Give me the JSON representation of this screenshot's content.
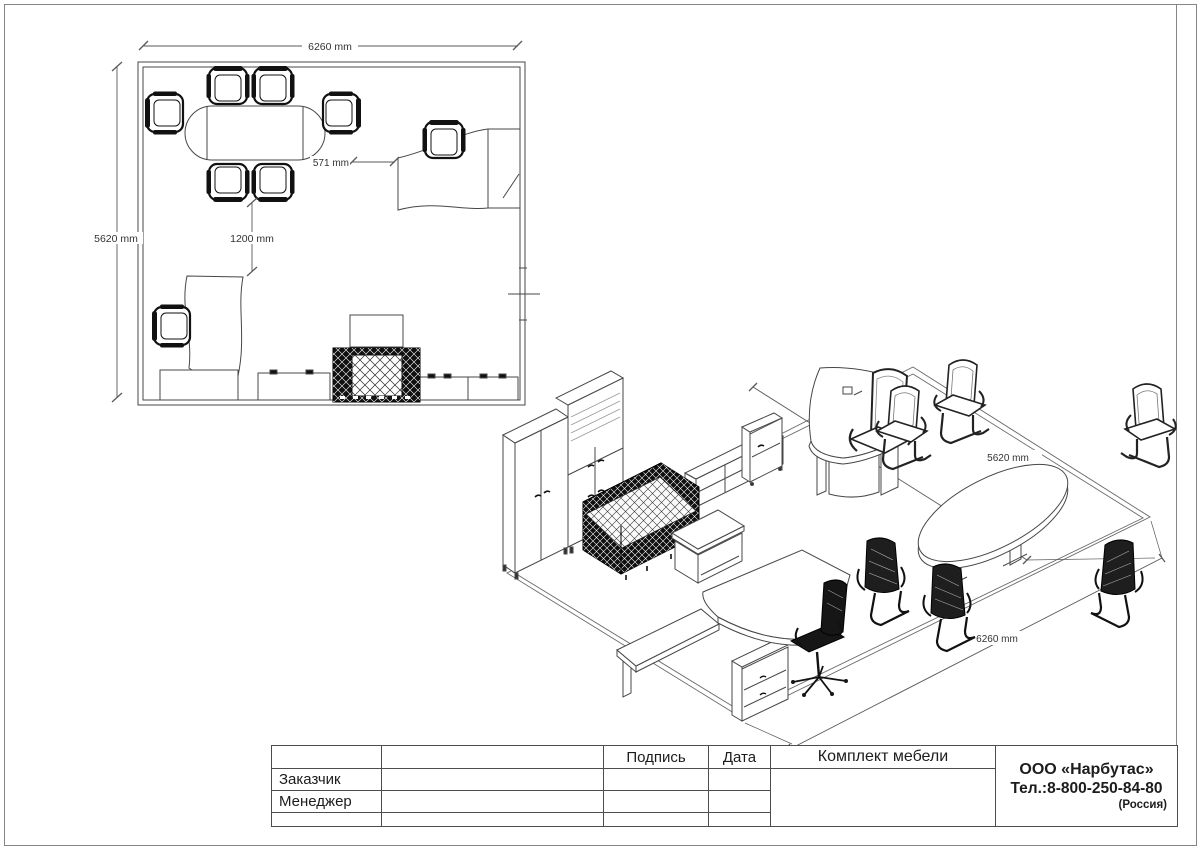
{
  "sheet": {
    "plan_view": {
      "dim_width_top": "6260 mm",
      "dim_depth_left": "5620 mm",
      "dim_table_to_desk": "571 mm",
      "dim_passage": "1200 mm"
    },
    "iso_view": {
      "dim_depth": "5620 mm",
      "dim_width": "6260 mm"
    },
    "title_block": {
      "signature_header": "Подпись",
      "date_header": "Дата",
      "customer_label": "Заказчик",
      "manager_label": "Менеджер",
      "document_title": "Комплект мебели",
      "company": {
        "name": "ООО «Нарбутас»",
        "phone": "Тел.:8-800-250-84-80",
        "country": "(Россия)"
      }
    },
    "colors": {
      "line": "#474747",
      "dark_fill": "#101010",
      "sheet_border": "#858585",
      "table_border": "#4d4d4d",
      "dim_text": "#333333"
    }
  }
}
